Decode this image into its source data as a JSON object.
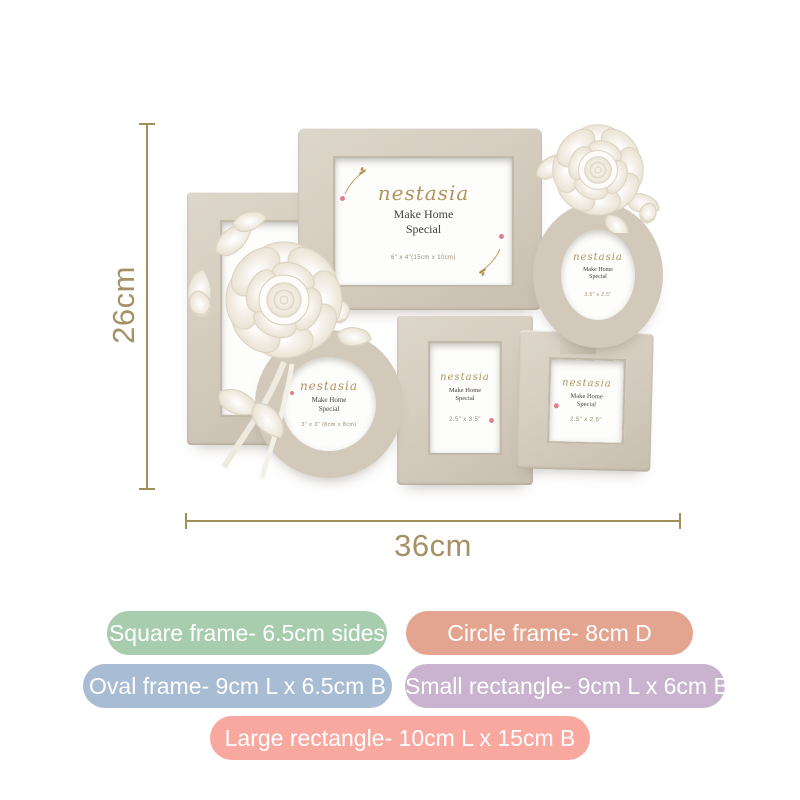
{
  "dimensions": {
    "height_label": "26cm",
    "width_label": "36cm",
    "line_color": "#a09058",
    "text_color": "#a59165"
  },
  "brand_insert": {
    "brand": "nestasia",
    "tagline_line1": "Make Home",
    "tagline_line2": "Special"
  },
  "frames": {
    "large_rect": {
      "size_caption": "6\" x 4\"(15cm x 10cm)"
    },
    "oval": {
      "size_caption": "3.5\" x 2.5\""
    },
    "circle": {
      "size_caption": "3\" x 3\" (8cm x 8cm)"
    },
    "small_rect": {
      "size_caption": "2.5\" x 3.5\""
    },
    "square": {
      "size_caption": "2.5\" x 2.5\""
    }
  },
  "product_colors": {
    "frame_taupe": "#d5cdc0",
    "rose_white": "#fdfcf9"
  },
  "badges": [
    {
      "label": "Square frame- 6.5cm sides",
      "color": "#a7cdae"
    },
    {
      "label": "Circle frame- 8cm D",
      "color": "#e3a58f"
    },
    {
      "label": "Oval frame- 9cm L x 6.5cm B",
      "color": "#a8bcd4"
    },
    {
      "label": "Small rectangle- 9cm L x 6cm B",
      "color": "#c9b3ce"
    },
    {
      "label": "Large rectangle- 10cm L x 15cm B",
      "color": "#f9a8a0"
    }
  ]
}
